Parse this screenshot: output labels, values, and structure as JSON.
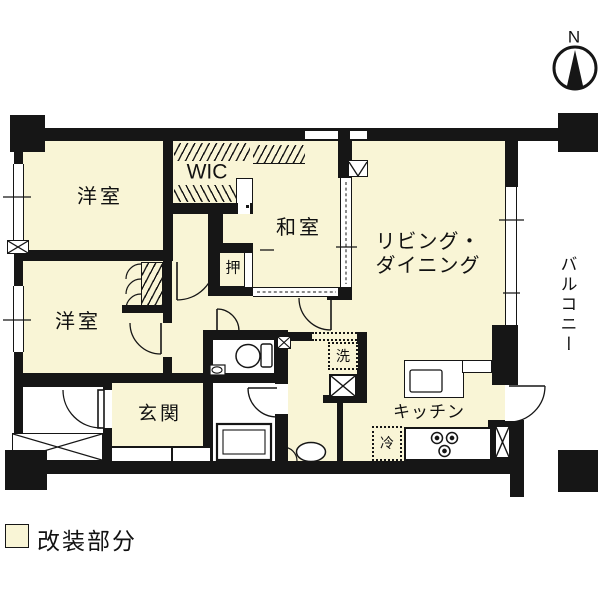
{
  "title": "マンション間取り図",
  "compass": {
    "north_label": "N"
  },
  "rooms": {
    "bedroom_top": {
      "label": "洋室"
    },
    "bedroom_bottom": {
      "label": "洋室"
    },
    "wic": {
      "label": "WIC"
    },
    "japanese_room": {
      "label": "和室"
    },
    "oshiire": {
      "label": "押"
    },
    "living_dining": {
      "label_line1": "リビング・",
      "label_line2": "ダイニング"
    },
    "entrance": {
      "label": "玄関"
    },
    "kitchen": {
      "label": "キッチン"
    },
    "washer": {
      "label": "洗"
    },
    "fridge": {
      "label": "冷"
    },
    "balcony": {
      "label": "バルコニー"
    }
  },
  "legend": {
    "label": "改装部分",
    "swatch_color": "#F9F5D6"
  },
  "colors": {
    "wall": "#161616",
    "renovated_fill": "#F9F5D6",
    "non_renovated_fill": "#FFFFFF"
  }
}
